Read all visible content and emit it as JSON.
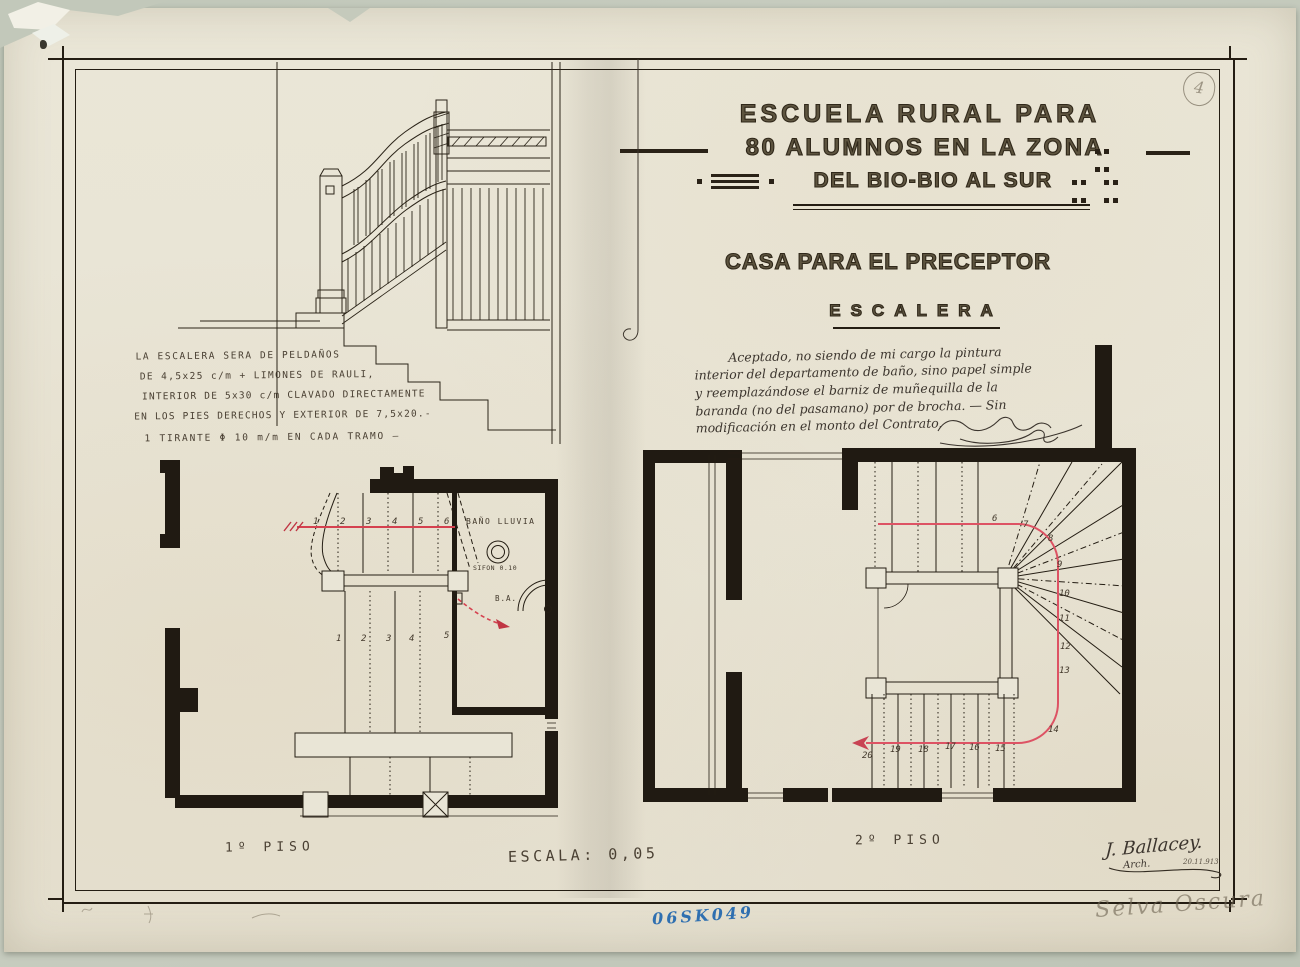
{
  "titles": {
    "line1": "ESCUELA RURAL PARA",
    "line2": "80 ALUMNOS EN LA ZONA",
    "line3": "DEL BIO-BIO AL SUR",
    "project": "CASA PARA EL PRECEPTOR",
    "drawing": "ESCALERA"
  },
  "spec_note": {
    "line1": "LA ESCALERA SERA DE PELDAÑOS",
    "line2": "DE 4,5x25 c/m + LIMONES DE RAULI,",
    "line3": "INTERIOR DE 5x30 c/m CLAVADO DIRECTAMENTE",
    "line4": "EN LOS PIES DERECHOS Y EXTERIOR DE 7,5x20.-",
    "line5": "1 TIRANTE Φ 10 m/m EN CADA TRAMO —"
  },
  "approval_note": {
    "line1": "Aceptado, no siendo de mi cargo la pintura",
    "line2": "interior del departamento de baño, sino papel simple",
    "line3": "y reemplazándose el barniz de muñequilla de la",
    "line4": "baranda (no del pasamano) por de brocha. — Sin",
    "line5": "modificación en el monto del Contrato."
  },
  "plan1": {
    "floor_label": "1º PISO",
    "bath_label": "BAÑO LLUVIA",
    "sifon_label": "SIFON 0.10",
    "ba_label": "B.A.",
    "upper_treads": [
      "1",
      "2",
      "3",
      "4",
      "5",
      "6"
    ],
    "middle_treads": [
      "1",
      "2",
      "3",
      "4",
      "5"
    ]
  },
  "plan2": {
    "floor_label": "2º PISO",
    "winder_treads": [
      "6",
      "7",
      "8",
      "9",
      "10",
      "11",
      "12",
      "13",
      "14"
    ],
    "lower_treads": [
      "15",
      "16",
      "17",
      "18",
      "19",
      "20"
    ]
  },
  "footer": {
    "scale_label": "ESCALA: 0,05",
    "registry_number": "06SK049",
    "pencil_note": "Selva Oscura",
    "sheet_number": "4"
  },
  "signature": {
    "name": "J. Ballacey.",
    "title": "Arch.",
    "date": "20.11.913"
  },
  "colors": {
    "paper": "#e9e5d6",
    "ink": "#241d13",
    "red": "#d5414f",
    "blue": "#2f6fb0",
    "pencil": "#6e6455"
  }
}
